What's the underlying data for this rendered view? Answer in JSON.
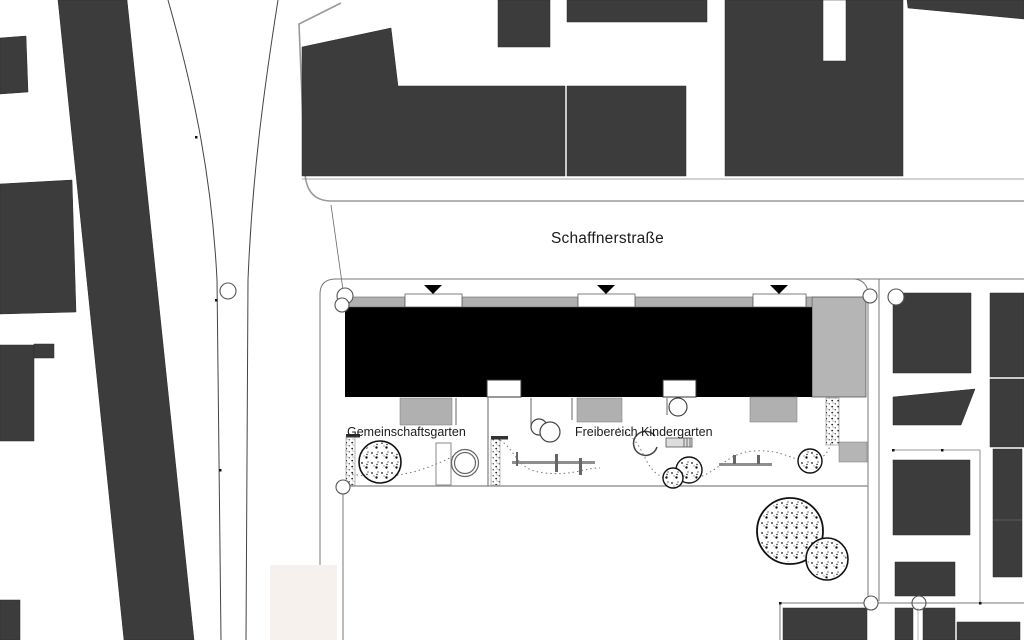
{
  "map": {
    "street_label": "Schaffnerstraße",
    "area_labels": {
      "community_garden": "Gemeinschaftsgarten",
      "kindergarten_outdoor": "Freibereich Kindergarten"
    },
    "markers": {
      "entrance_symbol": "filled-triangle-down",
      "entrance_count": 3,
      "tree_symbol": "speckled-circle",
      "survey_point_symbol": "small-circle"
    },
    "colors": {
      "existing_building": "#3c3c3c",
      "new_building_roof": "#000000",
      "roof_strip_gray": "#b0b0b0",
      "annex_gray": "#b5b5b5",
      "boundary_line": "#777777",
      "curb_line": "#444444",
      "paper": "#ffffff",
      "pink_parcel": "#f7f1ee"
    }
  }
}
